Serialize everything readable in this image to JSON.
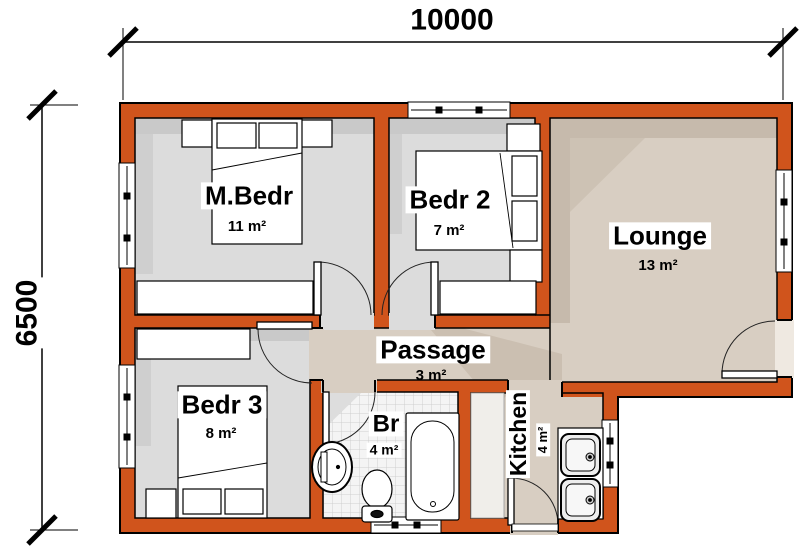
{
  "plan": {
    "type": "floor-plan",
    "dimensions": {
      "width": "10000",
      "height": "6500"
    },
    "rooms": [
      {
        "name": "M.Bedr",
        "area": "11 m²"
      },
      {
        "name": "Bedr 2",
        "area": "7 m²"
      },
      {
        "name": "Lounge",
        "area": "13 m²"
      },
      {
        "name": "Passage",
        "area": "3 m²"
      },
      {
        "name": "Bedr 3",
        "area": "8 m²"
      },
      {
        "name": "Br",
        "area": "4 m²"
      },
      {
        "name": "Kitchen",
        "area": "4 m²"
      }
    ],
    "colors": {
      "wall": "#D0541C",
      "outline": "#000000",
      "bedroom_floor": "#DCDCDC",
      "living_floor": "#D8CEC2",
      "shadow_beige": "#C6BAAC",
      "shadow_gray": "#C9C9C9",
      "tile": "#F4F4F4"
    }
  }
}
